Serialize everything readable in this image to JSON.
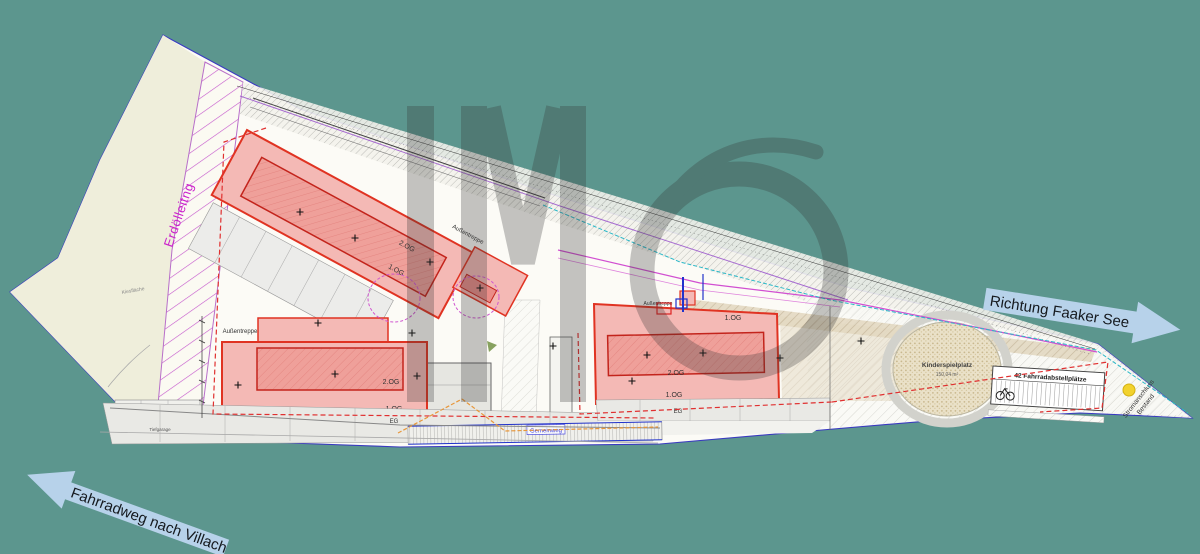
{
  "colors": {
    "background": "#5c968e",
    "paper": "#fcfbf6",
    "meadow": "#efeedb",
    "building_fill": "#f4b9b5",
    "building_core": "#efa09a",
    "building_border": "#e03322",
    "hatch_purple": "#c455cc",
    "pipeline_label_color": "#cc22cc",
    "arrow_fill": "#b7d2ea",
    "boundary_dash": "#e03030",
    "playground_fill": "#eae1c8",
    "power_dot": "#f2d22e",
    "path_label_color": "#3a3ae0"
  },
  "arrows": {
    "faaker_label": "Richtung Faaker See",
    "villach_label": "Fahrradweg nach Villach"
  },
  "site": {
    "pipeline_label": "Erdölleitng",
    "gravel_label": "Kiesfläche",
    "playground_label": "Kinderspielplatz",
    "playground_area": "150,04 m²",
    "bike_parking_label": "42 Fahrradabstellplätze",
    "power_label_line1": "Stromanschluss",
    "power_label_line2": "Bestand",
    "path_label": "Gemeinweg"
  },
  "buildings": {
    "stair_label": "Außentreppe",
    "floor_ground": "EG",
    "floor_first": "1.OG",
    "floor_second": "2.OG",
    "garage_label": "Tiefgarage"
  }
}
